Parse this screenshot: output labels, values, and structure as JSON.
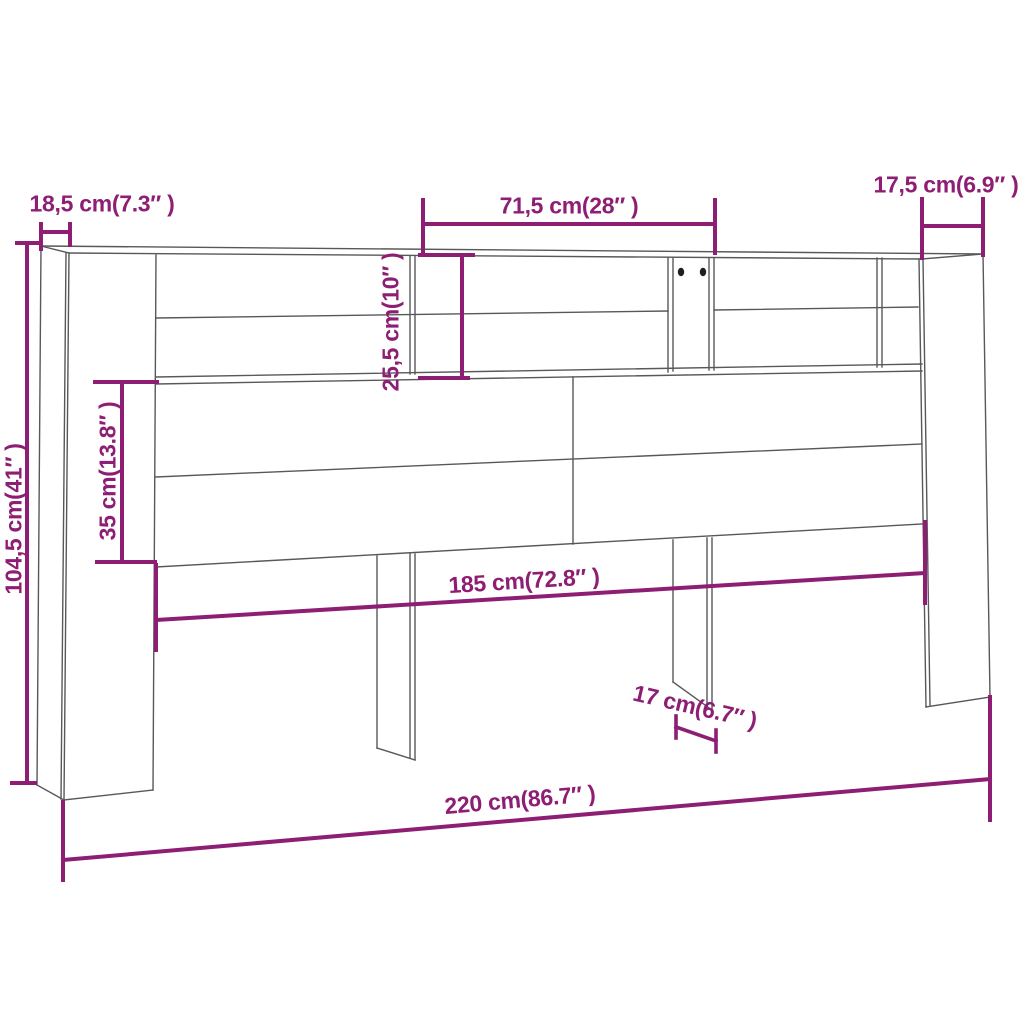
{
  "diagram": {
    "type": "furniture-dimension-drawing",
    "subject": "headboard cabinet with open compartments and support legs",
    "colors": {
      "background": "#ffffff",
      "outline": "#57585a",
      "dimension": "#8d1e73",
      "handles": "#1f1f1f"
    },
    "dimensions": {
      "side_depth_left": {
        "label": "18,5 cm(7.3″ )"
      },
      "top_section_width": {
        "label": "71,5 cm(28″ )"
      },
      "side_depth_right": {
        "label": "17,5 cm(6.9″ )"
      },
      "compartment_height": {
        "label": "25,5 cm(10″ )"
      },
      "panel_height": {
        "label": "35 cm(13.8″ )"
      },
      "total_height": {
        "label": "104,5 cm(41″ )"
      },
      "inner_width": {
        "label": "185 cm(72.8″ )"
      },
      "leg_depth": {
        "label": "17 cm(6.7″ )"
      },
      "total_width": {
        "label": "220 cm(86.7″ )"
      }
    }
  }
}
